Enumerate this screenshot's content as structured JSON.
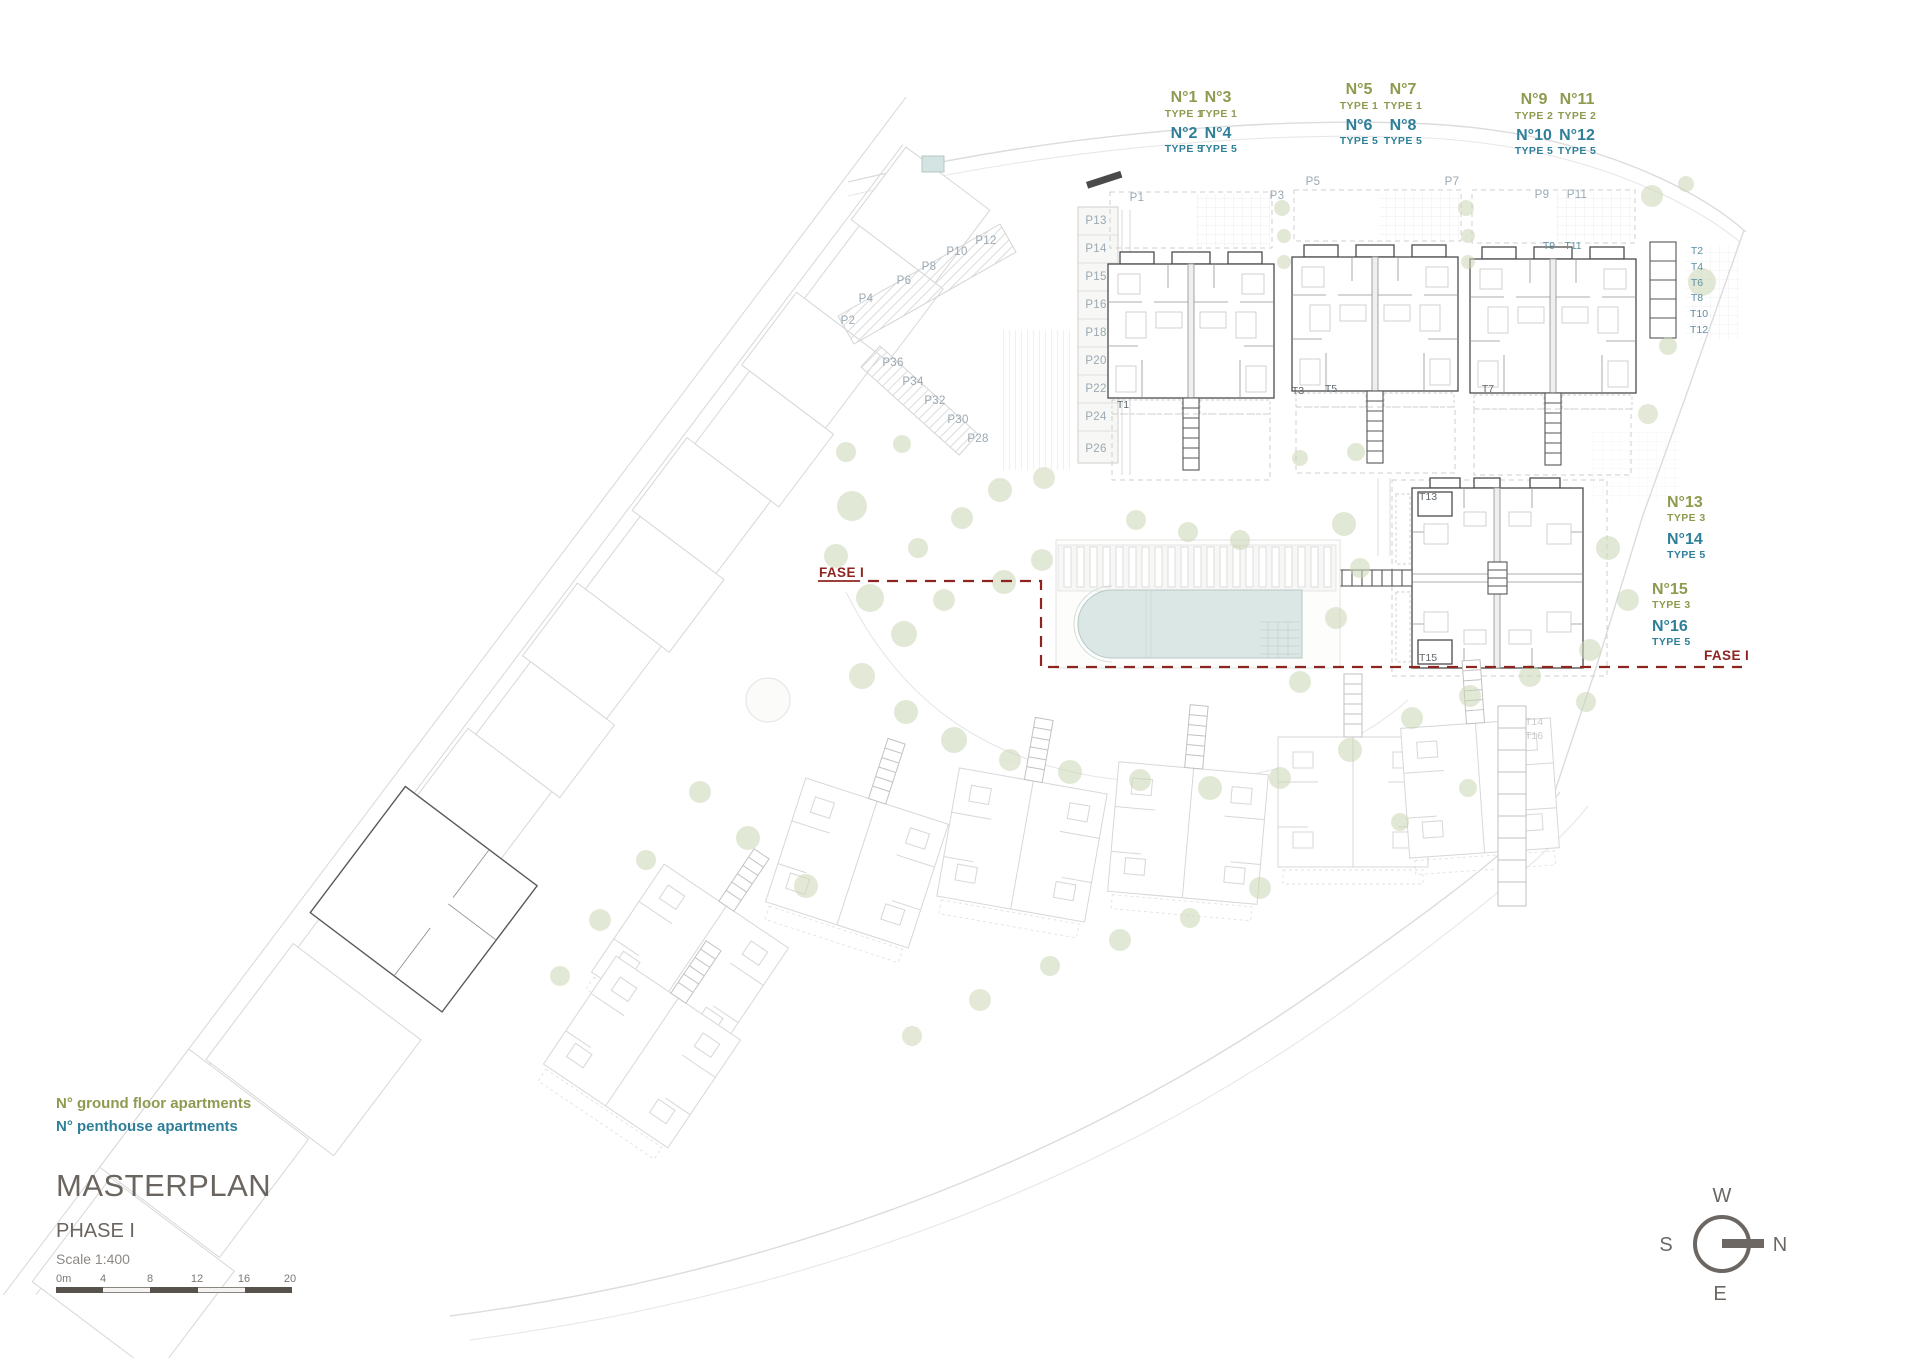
{
  "colors": {
    "ground_floor": "#8d9b50",
    "penthouse": "#2f7f99",
    "phase_line": "#8e2420",
    "title_gray": "#6b6560",
    "pool_water": "#dbe7e4",
    "tree_green": "#ccd6b6"
  },
  "legend": {
    "ground_floor": "N° ground floor apartments",
    "penthouse": "N° penthouse apartments"
  },
  "title_block": {
    "title": "MASTERPLAN",
    "phase": "PHASE I",
    "scale": "Scale 1:400",
    "scalebar_labels": [
      "0m",
      "4",
      "8",
      "12",
      "16",
      "20"
    ]
  },
  "compass": {
    "top": "W",
    "left": "S",
    "right": "N",
    "bottom": "E"
  },
  "phase_boundary": {
    "label": "FASE I",
    "left_label_pos": [
      819,
      577
    ],
    "right_label_pos": [
      1704,
      660
    ]
  },
  "apartment_groups": [
    {
      "cols": [
        1184,
        1218
      ],
      "y": 102,
      "ground": [
        {
          "no": "N°1",
          "type": "TYPE 1"
        },
        {
          "no": "N°3",
          "type": "TYPE 1"
        }
      ],
      "penthouse": [
        {
          "no": "N°2",
          "type": "TYPE 5"
        },
        {
          "no": "N°4",
          "type": "TYPE 5"
        }
      ]
    },
    {
      "cols": [
        1359,
        1403
      ],
      "y": 94,
      "ground": [
        {
          "no": "N°5",
          "type": "TYPE 1"
        },
        {
          "no": "N°7",
          "type": "TYPE 1"
        }
      ],
      "penthouse": [
        {
          "no": "N°6",
          "type": "TYPE 5"
        },
        {
          "no": "N°8",
          "type": "TYPE 5"
        }
      ]
    },
    {
      "cols": [
        1534,
        1577
      ],
      "y": 104,
      "ground": [
        {
          "no": "N°9",
          "type": "TYPE 2"
        },
        {
          "no": "N°11",
          "type": "TYPE 2"
        }
      ],
      "penthouse": [
        {
          "no": "N°10",
          "type": "TYPE 5"
        },
        {
          "no": "N°12",
          "type": "TYPE 5"
        }
      ]
    }
  ],
  "side_apartment_groups": [
    {
      "x": 1667,
      "y": 507,
      "ground": {
        "no": "N°13",
        "type": "TYPE 3"
      },
      "penthouse": {
        "no": "N°14",
        "type": "TYPE 5"
      }
    },
    {
      "x": 1652,
      "y": 594,
      "ground": {
        "no": "N°15",
        "type": "TYPE 3"
      },
      "penthouse": {
        "no": "N°16",
        "type": "TYPE 5"
      }
    }
  ],
  "parking_labels": [
    {
      "t": "P1",
      "x": 1137,
      "y": 201
    },
    {
      "t": "P3",
      "x": 1277,
      "y": 199
    },
    {
      "t": "P5",
      "x": 1313,
      "y": 185
    },
    {
      "t": "P7",
      "x": 1452,
      "y": 185
    },
    {
      "t": "P9",
      "x": 1542,
      "y": 198
    },
    {
      "t": "P11",
      "x": 1577,
      "y": 198
    },
    {
      "t": "P13",
      "x": 1096,
      "y": 224
    },
    {
      "t": "P14",
      "x": 1096,
      "y": 252
    },
    {
      "t": "P15",
      "x": 1096,
      "y": 280
    },
    {
      "t": "P16",
      "x": 1096,
      "y": 308
    },
    {
      "t": "P18",
      "x": 1096,
      "y": 336
    },
    {
      "t": "P20",
      "x": 1096,
      "y": 364
    },
    {
      "t": "P22",
      "x": 1096,
      "y": 392
    },
    {
      "t": "P24",
      "x": 1096,
      "y": 420
    },
    {
      "t": "P26",
      "x": 1096,
      "y": 452
    },
    {
      "t": "P2",
      "x": 848,
      "y": 324
    },
    {
      "t": "P4",
      "x": 866,
      "y": 302
    },
    {
      "t": "P6",
      "x": 904,
      "y": 284
    },
    {
      "t": "P8",
      "x": 929,
      "y": 270
    },
    {
      "t": "P10",
      "x": 957,
      "y": 255
    },
    {
      "t": "P12",
      "x": 986,
      "y": 244
    },
    {
      "t": "P36",
      "x": 893,
      "y": 366
    },
    {
      "t": "P34",
      "x": 913,
      "y": 385
    },
    {
      "t": "P32",
      "x": 935,
      "y": 404
    },
    {
      "t": "P30",
      "x": 958,
      "y": 423
    },
    {
      "t": "P28",
      "x": 978,
      "y": 442
    }
  ],
  "terrace_labels": [
    {
      "t": "T1",
      "x": 1123,
      "y": 408,
      "c": "dark"
    },
    {
      "t": "T3",
      "x": 1298,
      "y": 394,
      "c": "dark"
    },
    {
      "t": "T5",
      "x": 1331,
      "y": 392,
      "c": "dark"
    },
    {
      "t": "T7",
      "x": 1488,
      "y": 392,
      "c": "dark"
    },
    {
      "t": "T9",
      "x": 1549,
      "y": 249
    },
    {
      "t": "T11",
      "x": 1573,
      "y": 249
    },
    {
      "t": "T2",
      "x": 1697,
      "y": 254
    },
    {
      "t": "T4",
      "x": 1697,
      "y": 270
    },
    {
      "t": "T6",
      "x": 1697,
      "y": 286
    },
    {
      "t": "T8",
      "x": 1697,
      "y": 301
    },
    {
      "t": "T10",
      "x": 1699,
      "y": 317
    },
    {
      "t": "T12",
      "x": 1699,
      "y": 333
    },
    {
      "t": "T13",
      "x": 1428,
      "y": 500,
      "c": "dark"
    },
    {
      "t": "T15",
      "x": 1428,
      "y": 661,
      "c": "dark"
    },
    {
      "t": "T14",
      "x": 1534,
      "y": 725,
      "c": "faded"
    },
    {
      "t": "T16",
      "x": 1534,
      "y": 739,
      "c": "faded"
    }
  ]
}
